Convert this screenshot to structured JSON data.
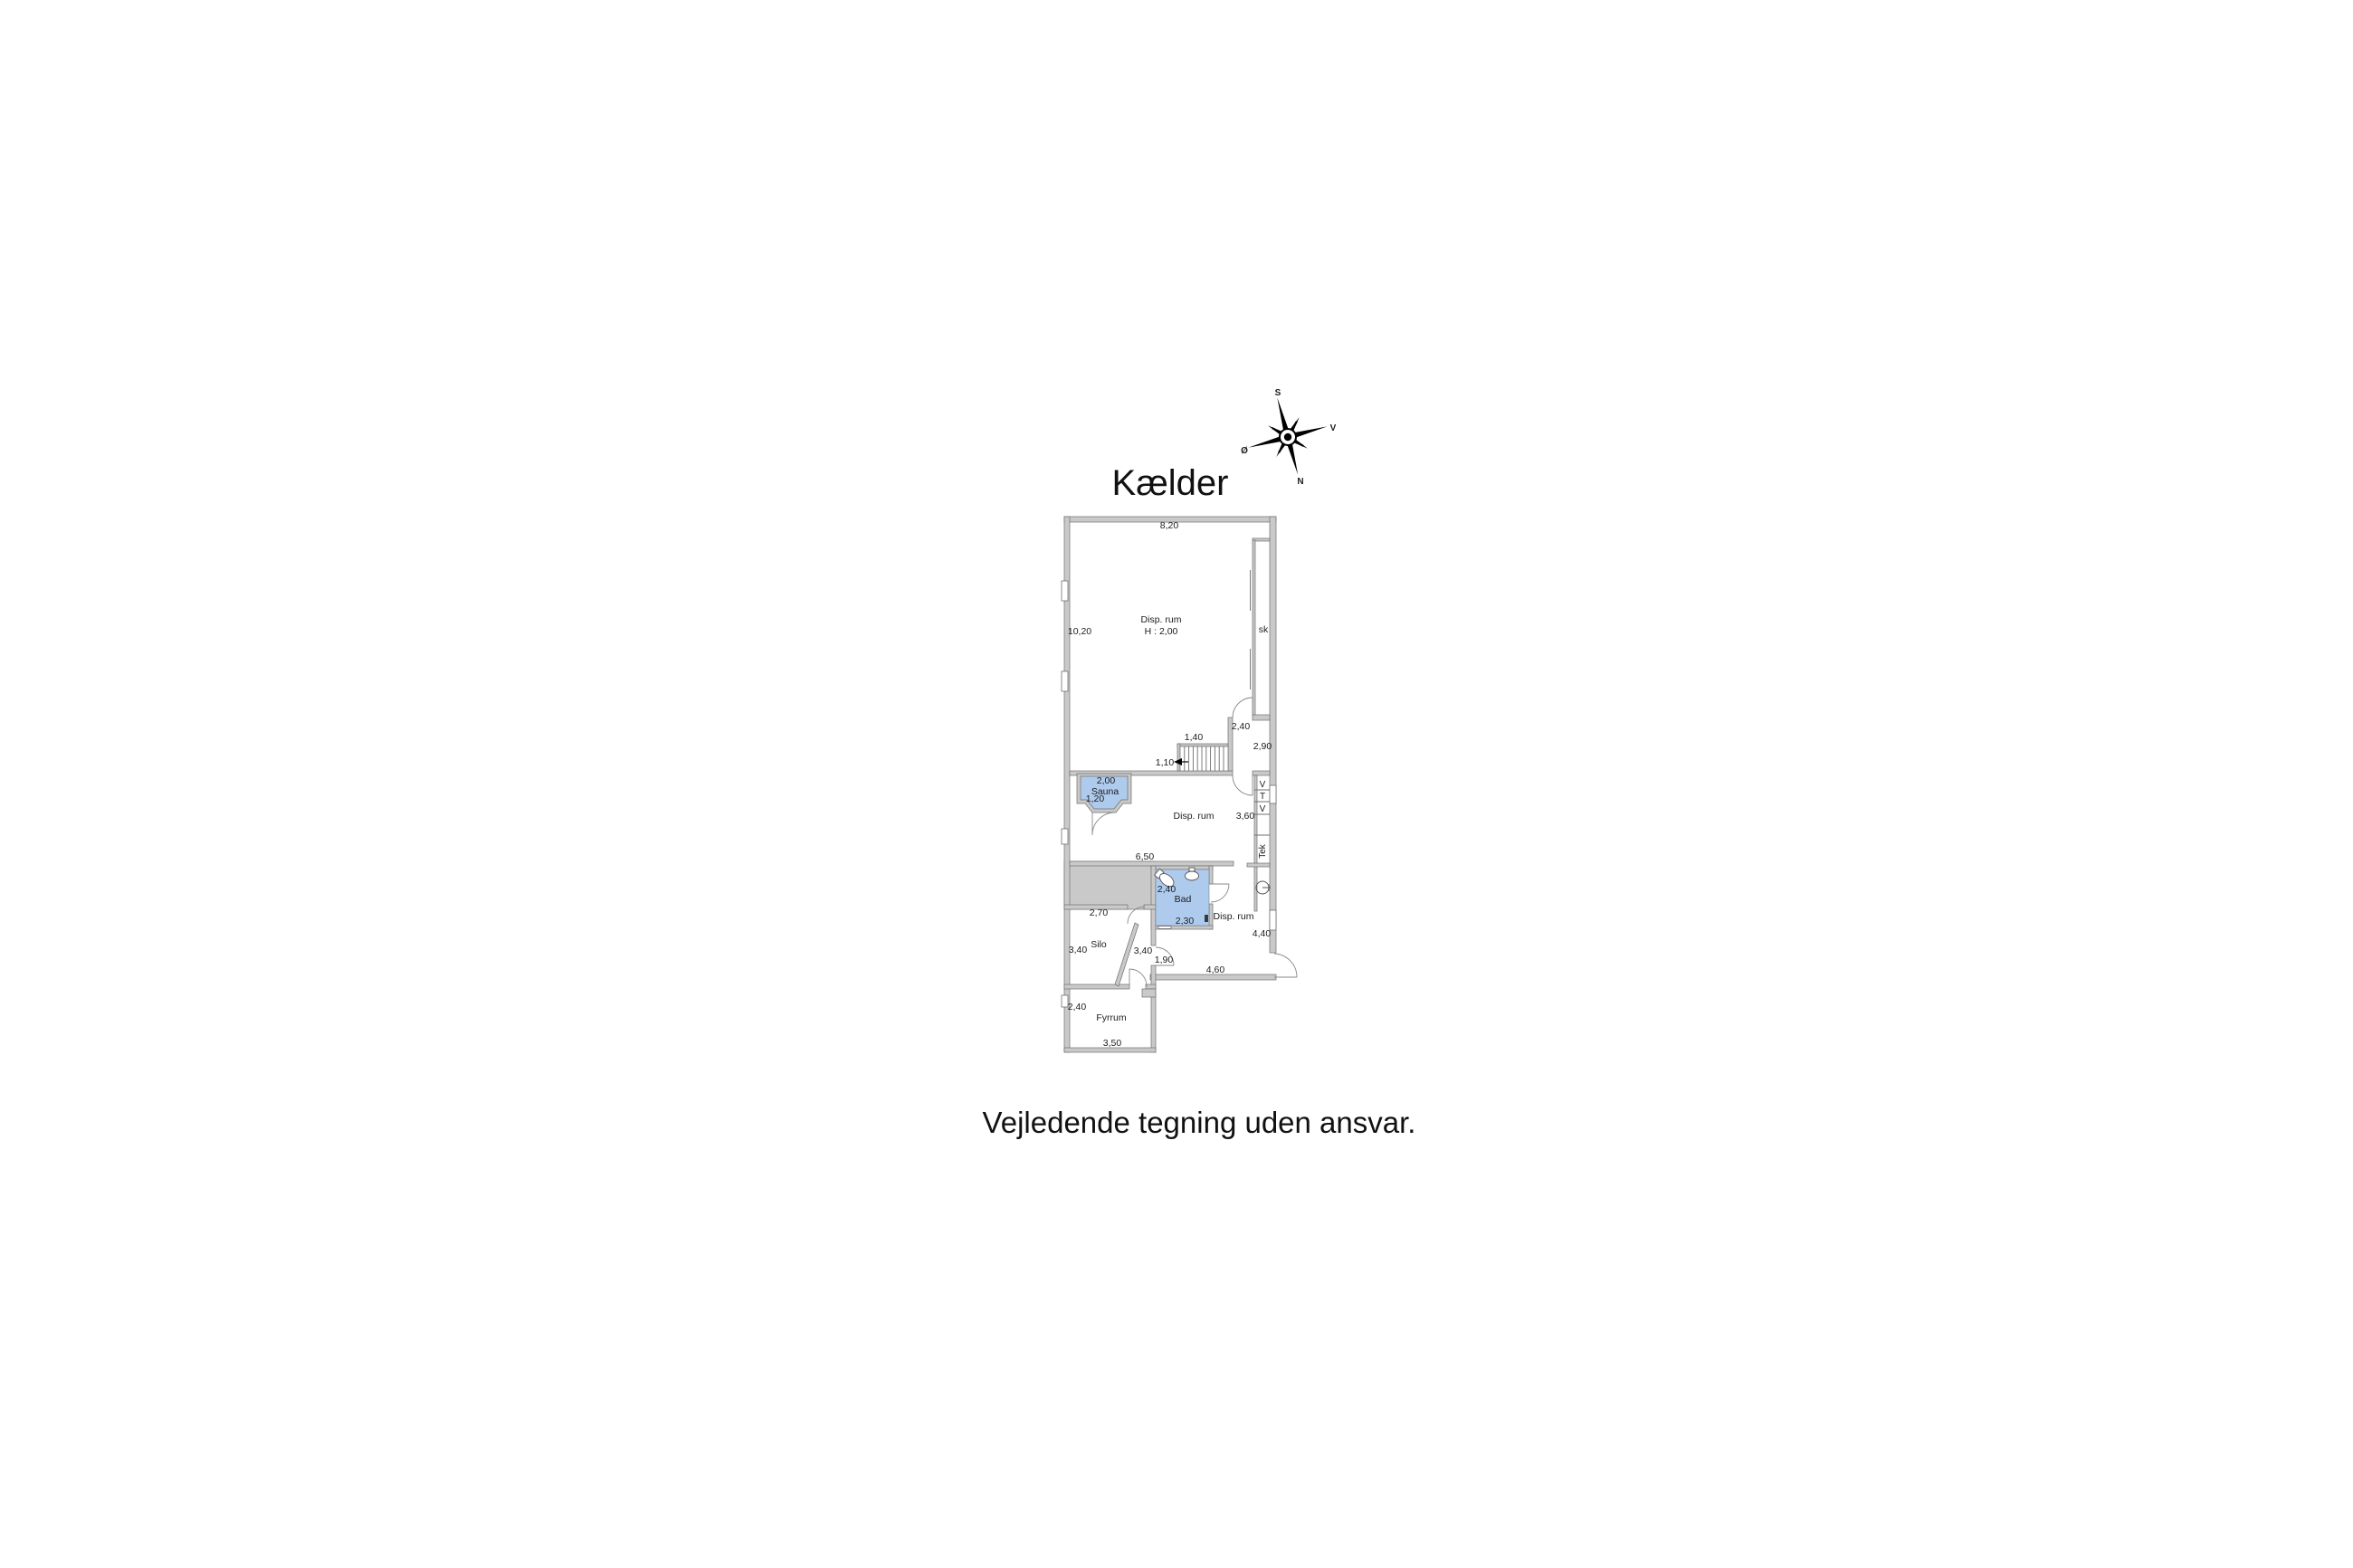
{
  "title": "Kælder",
  "disclaimer": "Vejledende tegning uden ansvar.",
  "compass": {
    "north": "N",
    "south": "S",
    "east": "Ø",
    "west": "V"
  },
  "plan": {
    "colors": {
      "wet_fill": "#aecbee",
      "wall_fill": "#c9c9c9",
      "wall_stroke": "#6f6f6f"
    },
    "rooms": {
      "top": {
        "label": "Disp. rum",
        "height": "H : 2,00"
      },
      "closet": "sk",
      "sauna": "Sauna",
      "middle": "Disp. rum",
      "bath": "Bad",
      "lower": "Disp. rum",
      "silo": "Silo",
      "boiler": "Fyrrum",
      "tech": "Tek",
      "compartments": [
        "V",
        "T",
        "V"
      ]
    },
    "dims": {
      "top_width": "8,20",
      "top_depth": "10,20",
      "landing_width": "2,40",
      "landing_depth": "2,90",
      "stairs_width": "1,40",
      "stairs_run": "1,10",
      "sauna_width": "2,00",
      "sauna_depth": "1,20",
      "middle_depth": "3,60",
      "middle_width": "6,50",
      "bath_depth": "2,40",
      "bath_width": "2,30",
      "lower_depth": "4,40",
      "lower_width": "4,60",
      "passage": "1,90",
      "silo_width": "2,70",
      "silo_depth": "3,40",
      "corridor_depth": "3,40",
      "boiler_window": "2,40",
      "boiler_width": "3,50"
    }
  }
}
